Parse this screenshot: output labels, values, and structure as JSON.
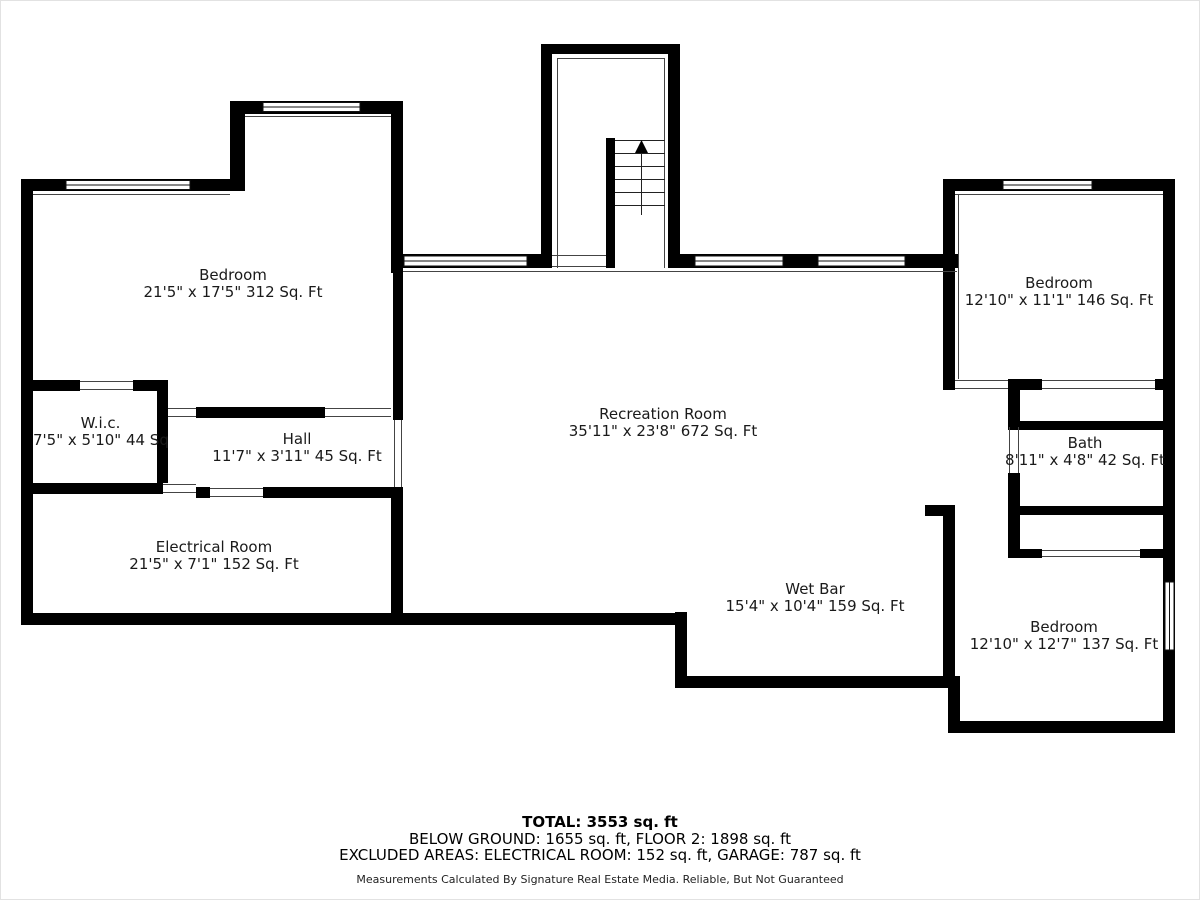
{
  "plan": {
    "rooms": [
      {
        "id": "bedroom-top-left",
        "name": "Bedroom",
        "dims": "21'5\" x 17'5\" 312 Sq. Ft"
      },
      {
        "id": "walk-in-closet",
        "name": "W.i.c.",
        "dims": "7'5\" x 5'10\" 44 Sq. Ft"
      },
      {
        "id": "hall",
        "name": "Hall",
        "dims": "11'7\" x 3'11\" 45 Sq. Ft"
      },
      {
        "id": "electrical-room",
        "name": "Electrical Room",
        "dims": "21'5\" x 7'1\" 152 Sq. Ft"
      },
      {
        "id": "recreation-room",
        "name": "Recreation Room",
        "dims": "35'11\" x 23'8\" 672 Sq. Ft"
      },
      {
        "id": "wet-bar",
        "name": "Wet Bar",
        "dims": "15'4\" x 10'4\" 159 Sq. Ft"
      },
      {
        "id": "bedroom-top-right",
        "name": "Bedroom",
        "dims": "12'10\" x 11'1\" 146 Sq. Ft"
      },
      {
        "id": "bath",
        "name": "Bath",
        "dims": "8'11\" x 4'8\" 42 Sq. Ft"
      },
      {
        "id": "bedroom-bottom-right",
        "name": "Bedroom",
        "dims": "12'10\" x 12'7\" 137 Sq. Ft"
      }
    ],
    "stairs": {
      "direction": "up",
      "icon": "up-arrow"
    }
  },
  "footer": {
    "total": "TOTAL: 3553 sq. ft",
    "breakdown": "BELOW GROUND: 1655 sq. ft, FLOOR 2: 1898 sq. ft",
    "excluded": "EXCLUDED AREAS: ELECTRICAL ROOM: 152 sq. ft, GARAGE: 787 sq. ft",
    "disclaimer": "Measurements Calculated By Signature Real Estate Media. Reliable, But Not Guaranteed"
  },
  "colors": {
    "wall": "#000000",
    "background": "#ffffff",
    "thin_line": "#444444",
    "text": "#1a1a1a"
  }
}
